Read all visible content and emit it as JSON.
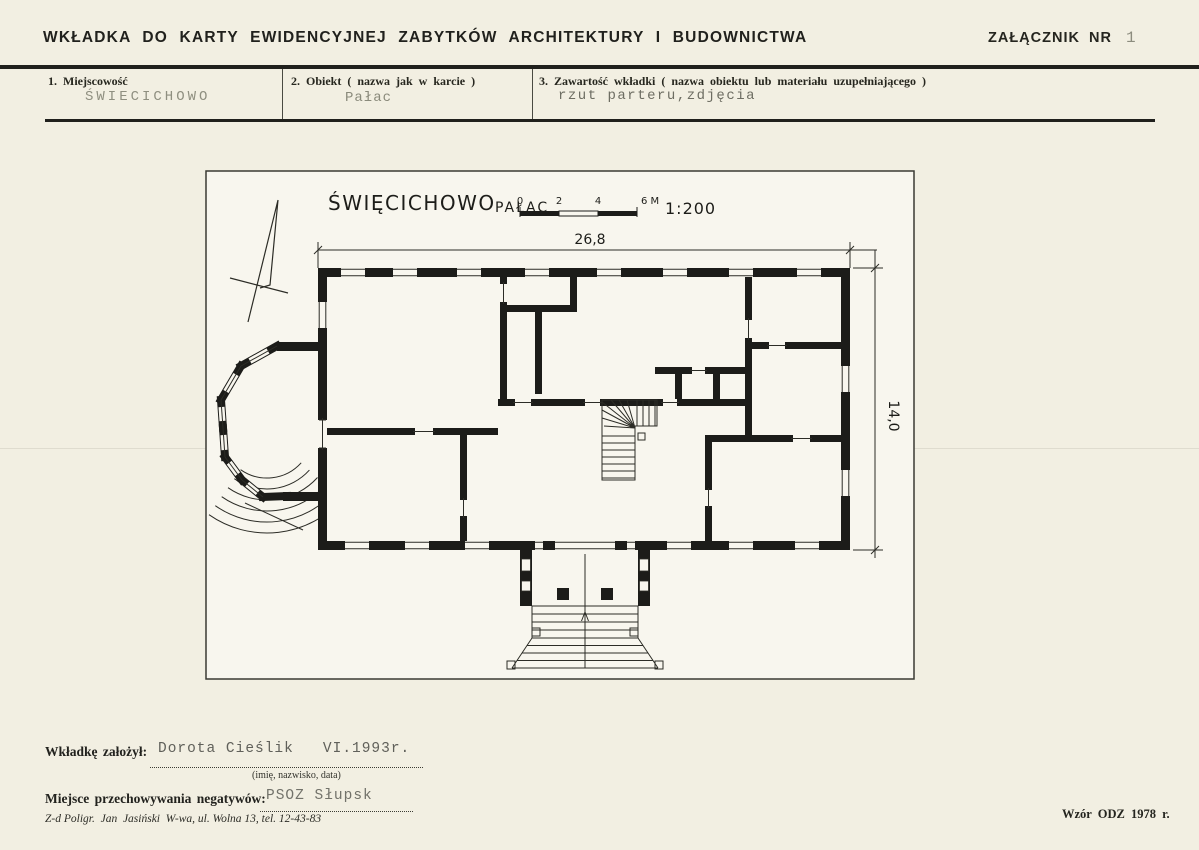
{
  "document": {
    "header": {
      "title": "WKŁADKA DO KARTY EWIDENCYJNEJ ZABYTKÓW ARCHITEKTURY I BUDOWNICTWA",
      "attachment_label": "ZAŁĄCZNIK NR",
      "attachment_number": "1"
    },
    "fields": [
      {
        "label": "1. Miejscowość",
        "value": "ŚWIECICHOWO"
      },
      {
        "label": "2. Obiekt ( nazwa jak w karcie )",
        "value": "Pałac"
      },
      {
        "label": "3. Zawartość wkładki ( nazwa obiektu lub materiału uzupełniającego )",
        "value": "rzut parteru,zdjęcia"
      }
    ],
    "drawing": {
      "title": "ŚWIĘCICHOWO",
      "subtitle": "PAŁAC",
      "scale_label": "1:200",
      "scale_ticks": [
        "0",
        "2",
        "4",
        "6 M"
      ],
      "dim_width": "26,8",
      "dim_height": "14,0"
    },
    "footer": {
      "founder_label": "Wkładkę założył:",
      "founder_value": "Dorota Cieślik   VI.1993r.",
      "founder_hint": "(imię, nazwisko, data)",
      "negatives_label": "Miejsce przechowywania negatywów:",
      "negatives_value": "PSOZ Słupsk",
      "printer_line": "Z-d Poligr.  Jan  Jasiński  W-wa, ul. Wolna 13, tel. 12-43-83",
      "template_note": "Wzór ODZ 1978 r."
    }
  }
}
